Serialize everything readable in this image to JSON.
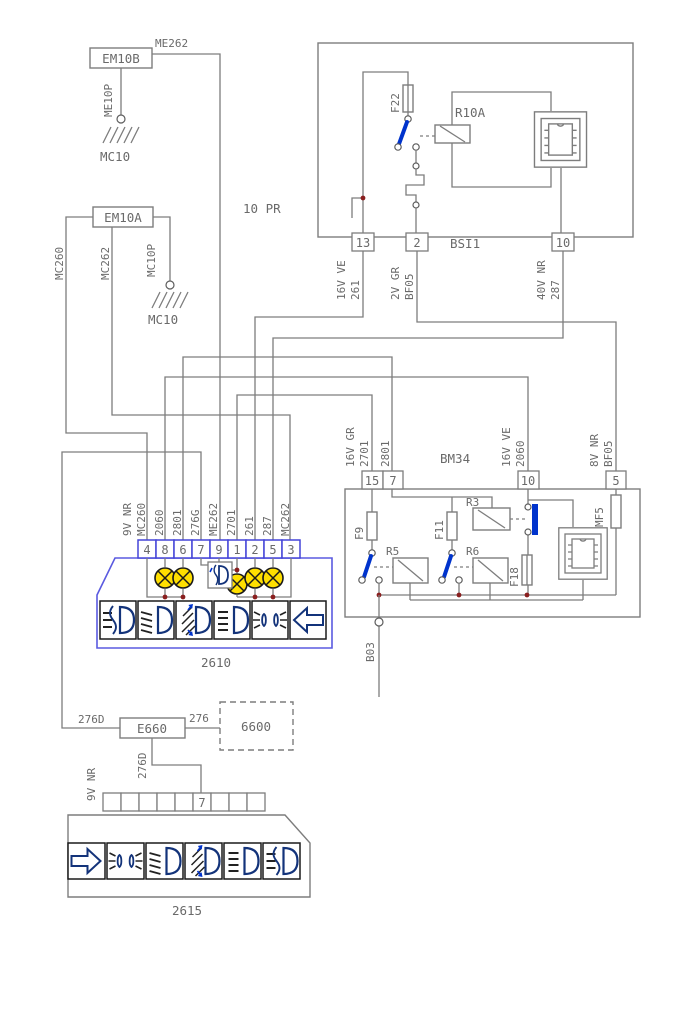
{
  "colors": {
    "wire_gray": "#7d7d7d",
    "text_gray": "#6a6a6a",
    "actuator_blue": "#0033cc",
    "unit_outline_blue": "#5a5ae0",
    "icon_blue": "#13337a",
    "lamp_yellow": "#ffdf00",
    "junction_red": "#8a1f1f"
  },
  "top_left": {
    "module": "EM10B",
    "wire_right": "ME262",
    "wire_down": "ME10P",
    "ground": "MC10"
  },
  "mid_left": {
    "module": "EM10A",
    "wire_left": "MC260",
    "wire_mid": "MC262",
    "wire_right": "MC10P",
    "ground": "MC10",
    "supply": "10 PR"
  },
  "bsi1": {
    "title": "BSI1",
    "fuse": "F22",
    "relay": "R10A",
    "pin13": {
      "num": "13",
      "l1": "16V VE",
      "l2": "261"
    },
    "pin2": {
      "num": "2",
      "l1": "2V GR",
      "l2": "BF05"
    },
    "pin10": {
      "num": "10",
      "l1": "40V NR",
      "l2": "287"
    }
  },
  "bm34": {
    "title": "BM34",
    "pin15": {
      "num": "15",
      "l1": "16V GR",
      "l2": "2701"
    },
    "pin7": {
      "num": "7",
      "l1": "2801"
    },
    "pin10": {
      "num": "10",
      "l1": "16V VE",
      "l2": "2060"
    },
    "pin5": {
      "num": "5",
      "l1": "8V NR",
      "l2": "BF05"
    },
    "f9": "F9",
    "f11": "F11",
    "f18": "F18",
    "mf5": "MF5",
    "r3": "R3",
    "r5": "R5",
    "r6": "R6",
    "b03": "B03"
  },
  "unit2610": {
    "title": "2610",
    "pins": [
      "4",
      "8",
      "6",
      "7",
      "9",
      "1",
      "2",
      "5",
      "3"
    ],
    "ground_l1": "9V NR",
    "ground_l2": "MC260",
    "wires": [
      "2060",
      "2801",
      "276G",
      "ME262",
      "2701",
      "261",
      "287",
      "MC262"
    ]
  },
  "bottom": {
    "splice": "E660",
    "wire_left": "276D",
    "wire_right": "276",
    "wire_down": "276D",
    "remote": "6600",
    "ground": "9V NR",
    "pin7": "7",
    "title": "2615"
  }
}
